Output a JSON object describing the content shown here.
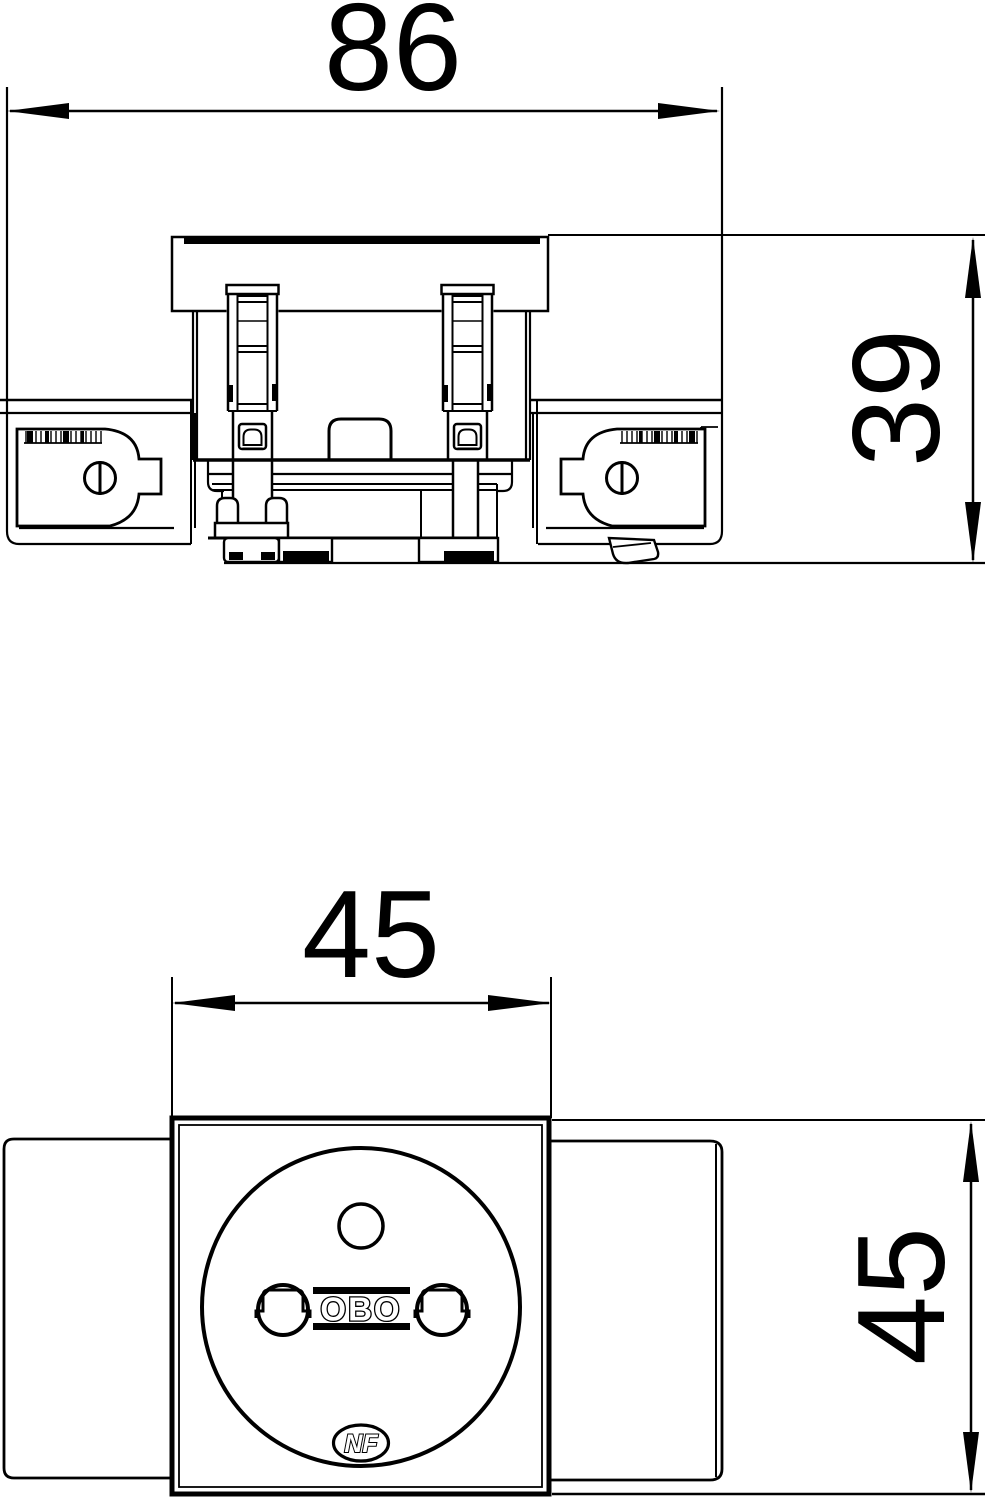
{
  "drawing": {
    "top_view": {
      "width_label": "86",
      "height_label": "39"
    },
    "front_view": {
      "width_label": "45",
      "height_label": "45"
    },
    "branding": {
      "manufacturer_logo": "OBO",
      "certification_mark": "NF"
    }
  }
}
